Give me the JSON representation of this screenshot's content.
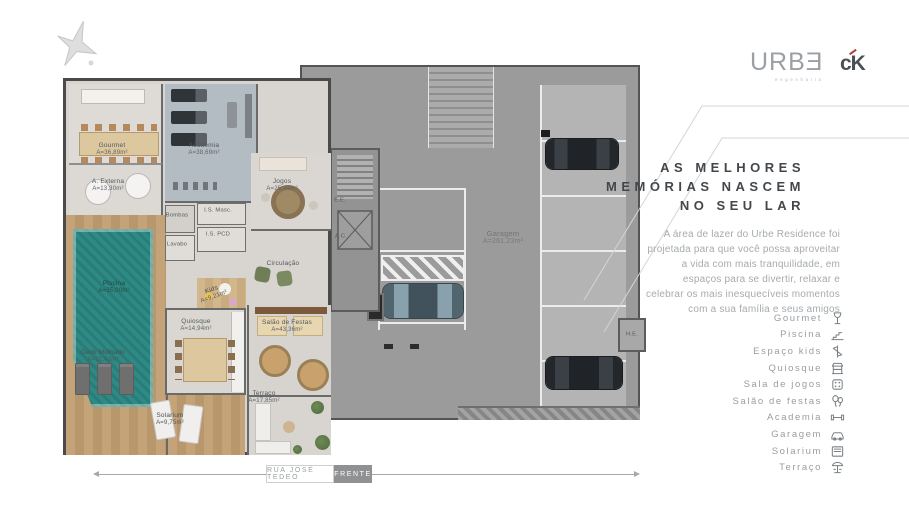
{
  "brand": {
    "urbe": "URBƎ",
    "urbe_sub": "engenharia",
    "ck": "cK"
  },
  "headline": {
    "line1": "AS MELHORES",
    "line2": "MEMÓRIAS NASCEM",
    "line3": "NO SEU LAR"
  },
  "paragraph": "A área de lazer do Urbe Residence foi projetada para que você possa aproveitar a vida com mais tranquilidade, em espaços para se divertir, relaxar e celebrar os mais inesquecíveis momentos com a sua família e seus amigos",
  "amenities": [
    {
      "label": "Gourmet",
      "icon": "wine-glass"
    },
    {
      "label": "Piscina",
      "icon": "pool-steps"
    },
    {
      "label": "Espaço kids",
      "icon": "toy"
    },
    {
      "label": "Quiosque",
      "icon": "kiosk"
    },
    {
      "label": "Sala de jogos",
      "icon": "game-die"
    },
    {
      "label": "Salão de festas",
      "icon": "balloons"
    },
    {
      "label": "Academia",
      "icon": "dumbbell"
    },
    {
      "label": "Garagem",
      "icon": "car"
    },
    {
      "label": "Solarium",
      "icon": "lounger"
    },
    {
      "label": "Terraço",
      "icon": "parasol"
    }
  ],
  "plan": {
    "rooms": [
      {
        "name": "Gourmet",
        "area": "A=36,89m²"
      },
      {
        "name": "A. Externa",
        "area": "A=13,30m²"
      },
      {
        "name": "Academia",
        "area": "A=38,69m²"
      },
      {
        "name": "Jogos",
        "area": "A=25,44m²"
      },
      {
        "name": "I.S. Masc.",
        "area": ""
      },
      {
        "name": "I.S. PCD",
        "area": ""
      },
      {
        "name": "Lavabo",
        "area": ""
      },
      {
        "name": "Bombas",
        "area": ""
      },
      {
        "name": "Circulação",
        "area": ""
      },
      {
        "name": "Piscina",
        "area": "A=35,00m²"
      },
      {
        "name": "Deck Molhado",
        "area": "A=12,42m²"
      },
      {
        "name": "Kids",
        "area": "A=9,21m²"
      },
      {
        "name": "Quiosque",
        "area": "A=14,94m²"
      },
      {
        "name": "Salão de Festas",
        "area": "A=43,36m²"
      },
      {
        "name": "Terraço",
        "area": "A=17,85m²"
      },
      {
        "name": "Solarium",
        "area": "A=9,75m²"
      },
      {
        "name": "E.E.",
        "area": ""
      },
      {
        "name": "A.C.",
        "area": ""
      },
      {
        "name": "Garagem",
        "area": "A=261,23m²"
      },
      {
        "name": "H.E.",
        "area": ""
      }
    ],
    "street": {
      "name": "RUA JOSÉ TEDEO",
      "badge": "FRENTE"
    }
  },
  "colors": {
    "pool": "#2e8a84",
    "deck_wood": "#bf9d72",
    "garage_floor": "#9b9b9b",
    "academia_floor": "#b3bbc3",
    "accent_red": "#b23c35",
    "headline_text": "#43474b",
    "muted_text": "#a6abae"
  }
}
